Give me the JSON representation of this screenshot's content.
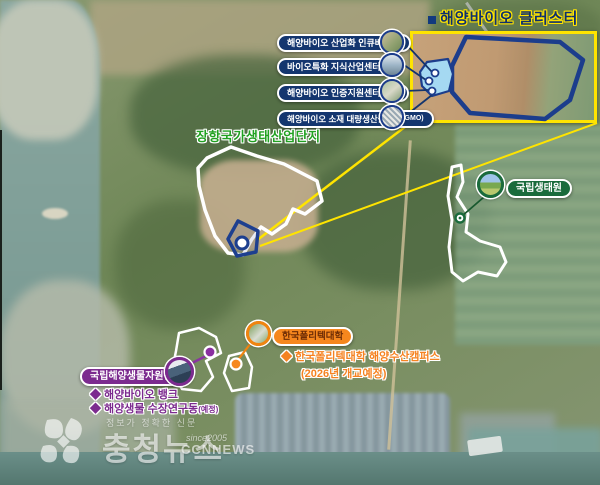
{
  "title": {
    "text": "해양바이오 클러스터"
  },
  "inset": {
    "labels": [
      {
        "text": "해양바이오 산업화 인큐베이터",
        "suffix": ""
      },
      {
        "text": "바이오특화 지식산업센터",
        "suffix": ""
      },
      {
        "text": "해양바이오 인증지원센터",
        "suffix": "(예정)"
      },
      {
        "text": "해양바이오 소재 대량생산플랜트",
        "suffix": "(GMO)"
      }
    ]
  },
  "areas": {
    "janghang_label": "장항국가생태산업단지",
    "ecology_label": "국립생태원",
    "polytech_label": "한국폴리텍대학",
    "mabik_label": "국립해양생물자원관"
  },
  "notes": {
    "polytech_line1": "◆ 한국폴리텍대학 해양수산캠퍼스",
    "polytech_line2": "(2026년 개교예정)",
    "mabik_line1": "◆ 해양바이오 뱅크",
    "mabik_line2": "◆ 해양생물 수장연구동",
    "mabik_line2_suffix": "(예정)"
  },
  "watermark": {
    "tagline": "정보가 정확한 신문",
    "name": "충청뉴스",
    "since": "since2005",
    "brand": "CCNNEWS"
  },
  "colors": {
    "accent_navy": "#14366f",
    "accent_yellow": "#ffe400",
    "accent_green": "#1a6b3c",
    "label_green": "#21a121",
    "accent_orange": "#f5851c",
    "orange_text": "#f58220",
    "accent_purple": "#7c2b8f",
    "inset_fill_blue": "#a5d9f2"
  }
}
